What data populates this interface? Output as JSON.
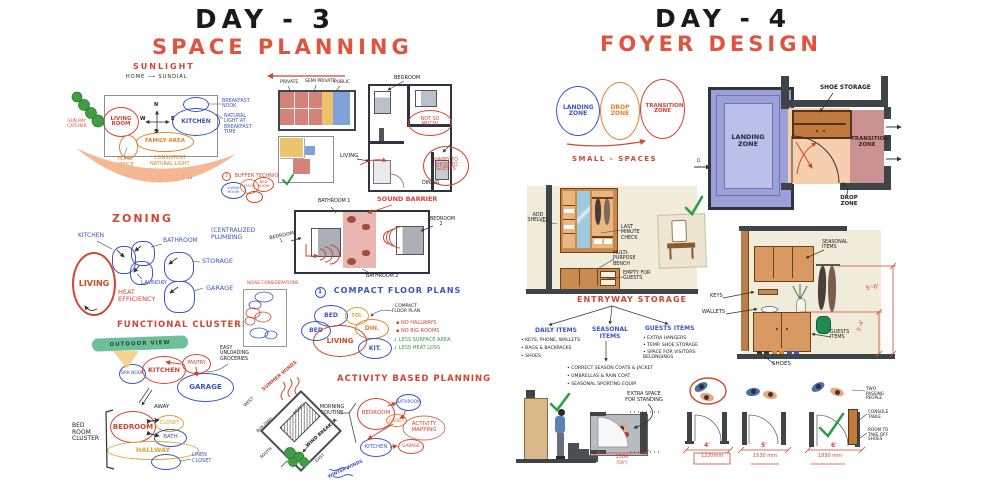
{
  "colors": {
    "red": "#cf4631",
    "blue": "#3a55c0",
    "orange": "#e0812f",
    "green": "#2f9e44",
    "yellow": "#d9a62e",
    "ink": "#202020",
    "purple": "#9ba1d6",
    "peach": "#f6cfae",
    "pink": "#cb9292",
    "wood": "#c98a52",
    "beige": "#f1ebd9",
    "wall": "#3f4448"
  },
  "day3": {
    "title": "DAY - 3",
    "subtitle": "SPACE PLANNING",
    "sunlight": {
      "title": "SUNLIGHT",
      "home_sundial": "HOME ⟶ SUNDIAL",
      "living_room": "LIVING ROOM",
      "kitchen": "KITCHEN",
      "family_area": "FAMILY AREA",
      "home_office": "HOME OFFICE",
      "breakfast_nook": "BREAKFAST NOOK",
      "natural_light": "NATURAL LIGHT AT BREAKFAST TIME",
      "consistent_light": "* CONSISTENT NATURAL LIGHT",
      "sun_path": "SUN PATH",
      "sun_ray_catcher": "SUN RAY CATCHER",
      "buffer_num": "1",
      "buffer": "BUFFER TECHNIQUE",
      "buffer_living": "LIVING ROOM",
      "buffer_family": "FAMILY",
      "buffer_bedroom": "BED ROOM",
      "n": "N",
      "s": "S",
      "e": "E",
      "w": "W"
    },
    "zoning": {
      "title": "ZONING",
      "kitchen": "KITCHEN",
      "bathroom": "BATHROOM",
      "laundry": "LAUNDRY",
      "living": "LIVING",
      "heat": "HEAT EFFICIENCY",
      "storage": "STORAGE",
      "garage": "GARAGE",
      "plumbing": "(CENTRALIZED PLUMBING"
    },
    "clusters": {
      "title": "FUNCTIONAL CLUSTERS",
      "outdoor": "OUTDOOR VIEW",
      "brk_nook": "BRK NOOK",
      "kitchen": "KITCHEN",
      "pantry": "PANTRY",
      "garage": "GARAGE",
      "easy": "EASY UNLOADING GROCERIES",
      "away": "AWAY",
      "bedroom": "BEDROOM",
      "closet": "CLOSET",
      "bath": "BATH",
      "hallway": "HALLWAY",
      "linen": "LINEN CLOSET",
      "cluster_label": "BED ROOM CLUSTER"
    },
    "privacy": {
      "private": "PRIVATE",
      "semi": "SEMI PRIVATE",
      "public": "PUBLIC"
    },
    "guest": {
      "bedroom": "BEDROOM",
      "not_so_much": "NOT SO MUCH!",
      "living": "LIVING",
      "happy": "HAPPY TO SHOW TO GUESTS",
      "dining": "DINING"
    },
    "sound": {
      "barrier": "SOUND BARRIER",
      "bathroom1": "BATHROOM 1",
      "bedroom1": "BEDROOM 1",
      "bedroom2": "BEDROOM 2",
      "bathroom2": "BATHROOM 2"
    },
    "noise": {
      "title": "NOISE CONSIDERATIONS"
    },
    "compact": {
      "num": "1",
      "title": "COMPACT FLOOR PLANS",
      "annotation": "COMPACT FLOOR PLAN",
      "bed1": "BED",
      "bed2": "BED",
      "toi": "TOI.",
      "living": "LIVING",
      "din": "DIN.",
      "kit": "KIT.",
      "note1": "▪ NO HALLWAYS",
      "note2": "▪ NO BIG ROOMS",
      "note3": "↓ LESS SURFACE AREA",
      "note4": "↓ LESS HEAT LOSS"
    },
    "site": {
      "summer": "SUMMER WINDS",
      "west": "WEST",
      "north": "NORTH",
      "building": "BUILDING",
      "wind_breaker": "WIND BREAKER",
      "south": "SOUTH",
      "east": "EAST",
      "winter": "WINTER WINDS"
    },
    "activity": {
      "title": "ACTIVITY BASED PLANNING",
      "routine": "MORNING ROUTINE",
      "bedroom": "BEDROOM",
      "bathroom": "BATHROOM",
      "closet": "CLOSET",
      "mapping": "ACTIVITY MAPPING",
      "kitchen": "KITCHEN",
      "garage": "GARAGE"
    }
  },
  "day4": {
    "title": "DAY - 4",
    "subtitle": "FOYER DESIGN",
    "zones": {
      "landing": "LANDING ZONE",
      "drop": "DROP ZONE",
      "transition": "TRANSITION ZONE",
      "small_spaces": "SMALL - SPACES"
    },
    "plan": {
      "landing": "LANDING ZONE",
      "shoe": "SHOE STORAGE",
      "transition": "TRANSITION ZONE",
      "drop": "DROP ZONE",
      "door": "D"
    },
    "elev": {
      "add_shelves": "ADD SHELVES",
      "last_minute": "LAST MINUTE CHECK",
      "bench": "MULTI-PURPOSE BENCH",
      "empty": "EMPTY FOR GUESTS"
    },
    "storage": {
      "title": "ENTRYWAY STORAGE",
      "daily_title": "DAILY ITEMS",
      "daily1": "• KEYS, PHONE, WALLETS",
      "daily2": "• BAGS & BACKPACKS",
      "daily3": "• SHOES",
      "seasonal_title": "SEASONAL ITEMS",
      "seasonal1": "• CORRECT SEASON COATS & JACKET",
      "seasonal2": "• UMBRELLAS & RAIN COAT",
      "seasonal3": "• SEASONAL SPORTING EQUIP.",
      "guests_title": "GUESTS ITEMS",
      "guests1": "• EXTRA HANGERS",
      "guests2": "• TEMP. SHOE STORAGE",
      "guests3": "• SPACE FOR VISITORS BELONGINGS"
    },
    "relev": {
      "seasonal": "SEASONAL ITEMS",
      "keys": "KEYS",
      "wallets": "WALLETS",
      "guests": "GUESTS ITEMS",
      "shoes": "SHOES",
      "dim_high": "5'-6'",
      "dim_low": "3'-4'"
    },
    "standing": {
      "label": "EXTRA SPACE FOR STANDING",
      "dim_mm": "1500",
      "dim_in": "(59\")"
    },
    "widths": {
      "w1_ft": "4'",
      "w1_mm": "1220mm",
      "w2_ft": "5'",
      "w2_mm": "1530 mm",
      "w3_ft": "6'",
      "w3_mm": "1830 mm",
      "note1": "TWO PASSING PEOPLE",
      "note2": "CONSOLE TABLE",
      "note3": "ROOM TO TAKE OFF SHOES"
    }
  }
}
